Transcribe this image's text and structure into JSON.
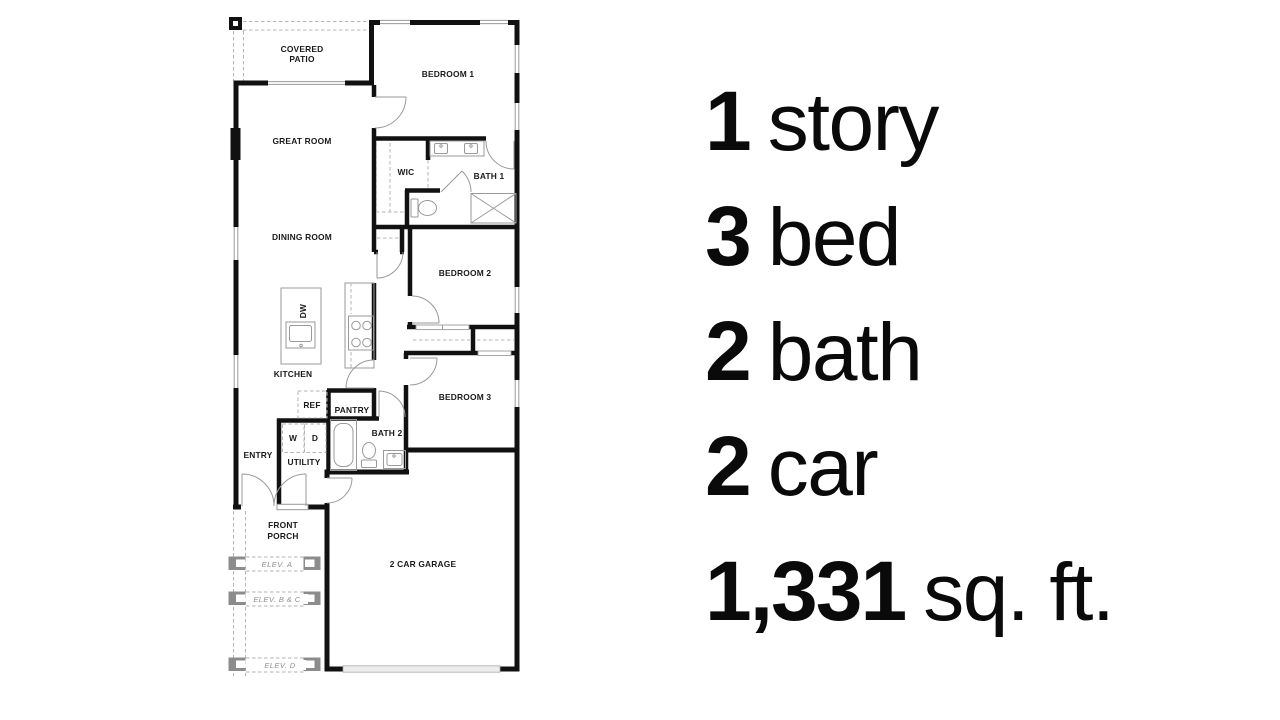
{
  "plan": {
    "labels": {
      "covered_patio_line1": "COVERED",
      "covered_patio_line2": "PATIO",
      "bedroom1": "BEDROOM 1",
      "great_room": "GREAT ROOM",
      "wic": "WIC",
      "bath1": "BATH 1",
      "dining_room": "DINING ROOM",
      "bedroom2": "BEDROOM 2",
      "dw": "DW",
      "kitchen": "KITCHEN",
      "ref": "REF",
      "pantry": "PANTRY",
      "bedroom3": "BEDROOM 3",
      "bath2": "BATH 2",
      "washer": "W",
      "dryer": "D",
      "entry": "ENTRY",
      "utility": "UTILITY",
      "front_porch_line1": "FRONT",
      "front_porch_line2": "PORCH",
      "garage": "2 CAR GARAGE",
      "elev_a": "ELEV. A",
      "elev_bc": "ELEV. B & C",
      "elev_d": "ELEV. D"
    },
    "colors": {
      "wall": "#111111",
      "fixture_line": "#9a9a9a",
      "dashed_line": "#b3b3b3",
      "elev_text": "#8f8f8f",
      "label_text": "#1a1a1a"
    }
  },
  "stats": {
    "items": [
      {
        "value": "1",
        "label": "story"
      },
      {
        "value": "3",
        "label": "bed"
      },
      {
        "value": "2",
        "label": "bath"
      },
      {
        "value": "2",
        "label": "car"
      },
      {
        "value": "1,331",
        "label": "sq. ft."
      }
    ]
  }
}
